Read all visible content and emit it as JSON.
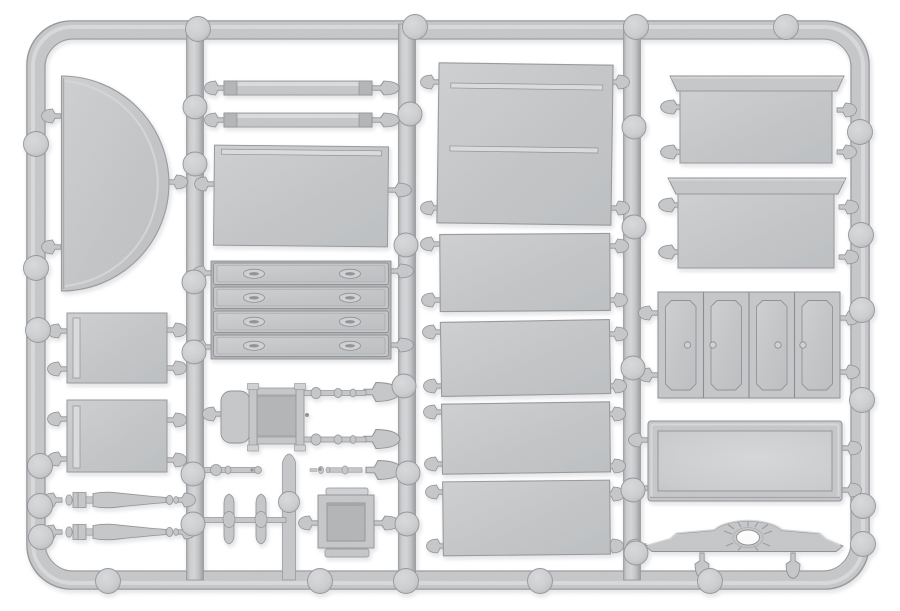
{
  "meta": {
    "title": "Light grey injection-moulded plastic sprue of miniature furniture parts",
    "part_colour_name": "light grey polystyrene"
  },
  "colors": {
    "background": "#ffffff",
    "plastic": "#c6c8ca",
    "plastic_light": "#dcdddd",
    "plastic_dark": "#909396",
    "panel_light": "#d2d3d4",
    "recess": "#b4b6b8",
    "hole": "#ffffff"
  },
  "parts": {
    "frame": {
      "label": "outer sprue frame"
    },
    "runners": {
      "label": "vertical runner rails"
    },
    "stub": {
      "label": "short runner stub"
    },
    "gates": {
      "label": "sprue gates"
    },
    "ejector_marks": {
      "label": "ejector pin marks"
    },
    "half_round_top": {
      "label": "half-round table top"
    },
    "bed_rails": {
      "label": "pair of long rails"
    },
    "table_top": {
      "label": "table top panel with edge moulding"
    },
    "drawer_fronts": {
      "label": "four drawer fronts with oval handles"
    },
    "chair_frame": {
      "label": "chair frame with panel and turned stretchers"
    },
    "finial_spindles": {
      "label": "small turned finial spindles"
    },
    "turned_legs": {
      "label": "two turned table legs"
    },
    "trestle_foot": {
      "label": "trestle cross-foot piece"
    },
    "drawer_box": {
      "label": "small square drawer box"
    },
    "side_panels": {
      "label": "two square side panels"
    },
    "flat_panels": {
      "label": "five flat cabinet panels"
    },
    "cornice_panels": {
      "label": "two flared cornice panels"
    },
    "folding_doors": {
      "label": "four-panel folding door with knobs"
    },
    "tray": {
      "label": "rectangular tray with raised rim"
    },
    "pediment": {
      "label": "pediment crest with sunburst and oval cut-out"
    }
  }
}
